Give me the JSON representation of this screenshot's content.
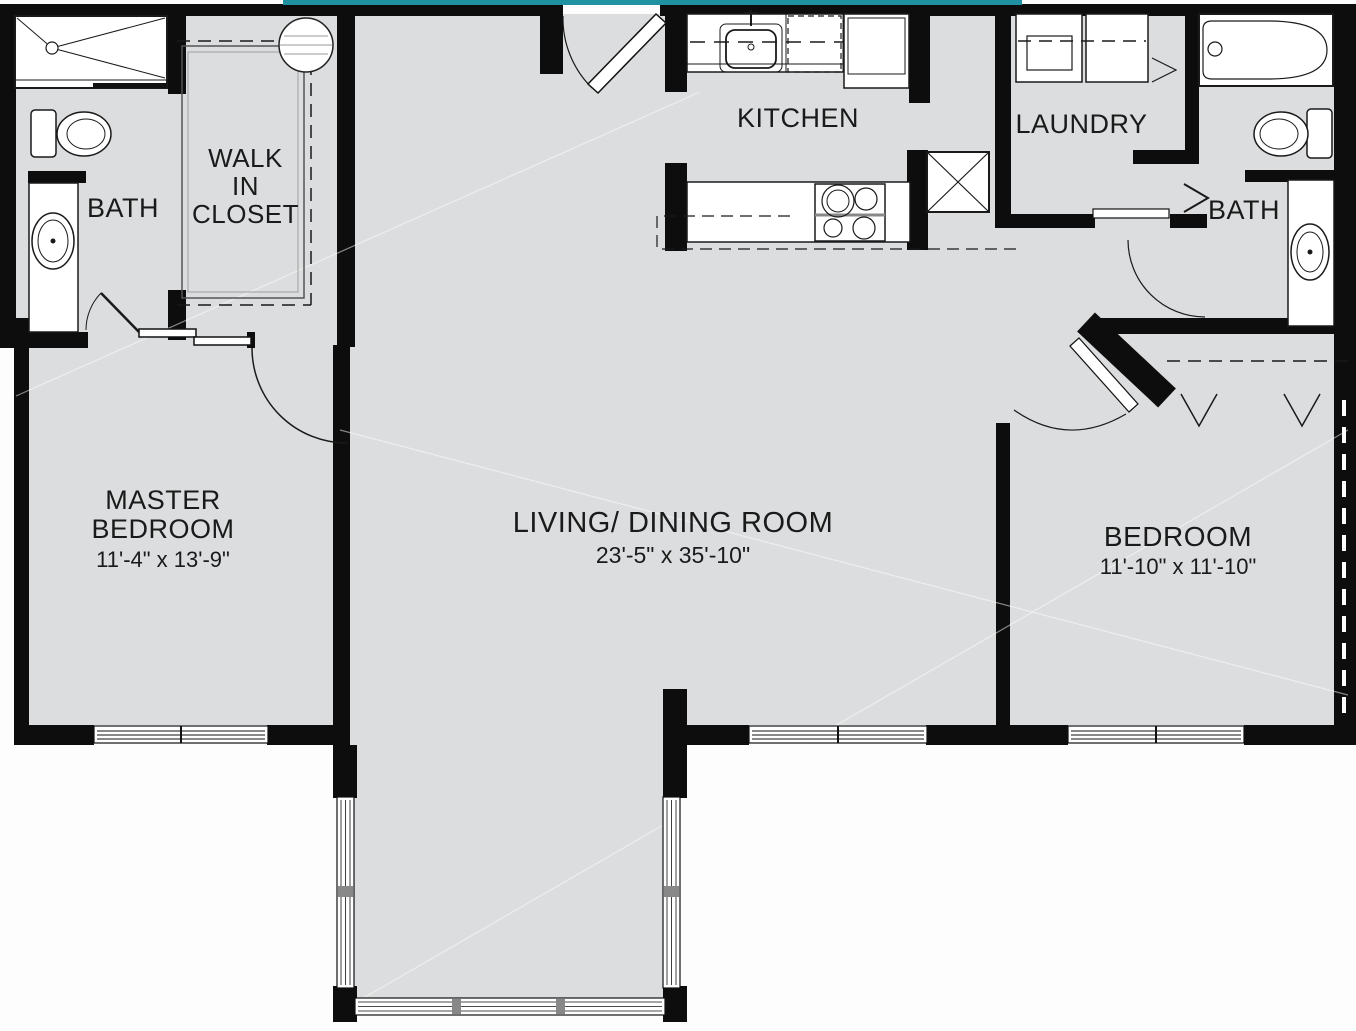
{
  "document": {
    "type": "architectural floor plan"
  },
  "colors": {
    "accent_teal": "#1f91a1",
    "wall_black": "#0d0d0d",
    "floor_gray": "#dcddde",
    "fixture_white": "#ffffff",
    "background": "#fdfdfd"
  },
  "rooms": {
    "master_bedroom": {
      "line1": "MASTER",
      "line2": "BEDROOM",
      "dimensions": "11'-4\" x 13'-9\""
    },
    "walk_in_closet": {
      "line1": "WALK",
      "line2": "IN",
      "line3": "CLOSET"
    },
    "bath_master": {
      "name": "BATH"
    },
    "kitchen": {
      "name": "KITCHEN"
    },
    "laundry": {
      "name": "LAUNDRY"
    },
    "bath_second": {
      "name": "BATH"
    },
    "living_dining": {
      "name": "LIVING/ DINING ROOM",
      "dimensions": "23'-5\" x 35'-10\""
    },
    "bedroom": {
      "name": "BEDROOM",
      "dimensions": "11'-10\" x 11'-10\""
    }
  },
  "fixtures": {
    "master_bath": [
      "shower",
      "toilet",
      "vanity-sink"
    ],
    "walk_in_closet": [
      "shelving",
      "rod"
    ],
    "kitchen": [
      "sink",
      "dishwasher",
      "refrigerator",
      "counter",
      "range",
      "pantry-cabinet"
    ],
    "laundry": [
      "washer",
      "dryer"
    ],
    "second_bath": [
      "bathtub",
      "toilet",
      "vanity-sink"
    ],
    "bedroom": [
      "closet-bifold-doors"
    ],
    "patio": [
      "window-walls"
    ]
  }
}
